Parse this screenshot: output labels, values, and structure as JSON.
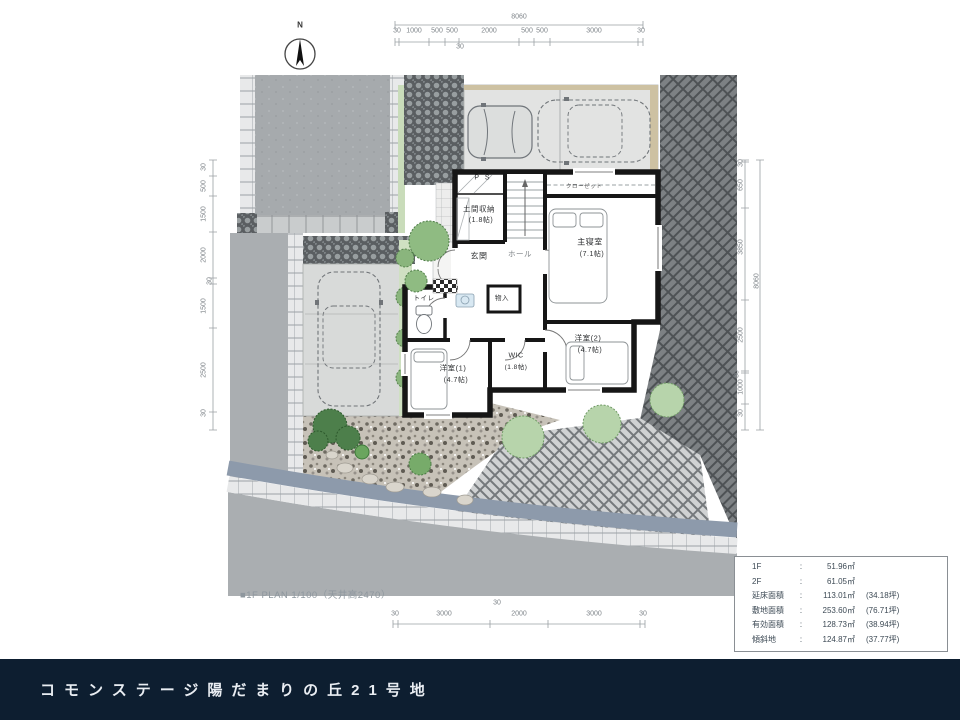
{
  "footer": {
    "title": "コモンステージ陽だまりの丘21号地"
  },
  "caption": "■1F PLAN 1/100（天井高2470）",
  "north_label": "N",
  "dimensions": {
    "top": {
      "total": "8060",
      "sub": "30",
      "segments": [
        "30",
        "1000",
        "500",
        "500",
        "2000",
        "500",
        "500",
        "3000",
        "30"
      ]
    },
    "bottom": {
      "sub": "30",
      "segments": [
        "30",
        "3000",
        "2000",
        "3000",
        "30"
      ]
    },
    "left": {
      "segments": [
        "30",
        "500",
        "1500",
        "2000",
        "30",
        "1500",
        "2500",
        "30"
      ]
    },
    "right": {
      "total": "8060",
      "segments": [
        "30",
        "650",
        "3850",
        "2500",
        "30",
        "1000",
        "30"
      ]
    }
  },
  "rooms": {
    "ps": "P S",
    "doma": "土間収納",
    "doma_size": "(1.8帖)",
    "genkan": "玄関",
    "hall": "ホール",
    "closet": "クローゼット",
    "master": "主寝室",
    "master_size": "(7.1帖)",
    "monoire": "物入",
    "toilet": "トイレ",
    "west1": "洋室(1)",
    "west1_size": "(4.7帖)",
    "wic": "WIC",
    "wic_size": "(1.8帖)",
    "west2": "洋室(2)",
    "west2_size": "(4.7帖)"
  },
  "area_table": {
    "colon": ":",
    "rows": [
      {
        "label": "1F",
        "value": "51.96㎡",
        "tsubo": ""
      },
      {
        "label": "2F",
        "value": "61.05㎡",
        "tsubo": ""
      },
      {
        "label": "延床面積",
        "value": "113.01㎡",
        "tsubo": "(34.18坪)"
      },
      {
        "label": "敷地面積",
        "value": "253.60㎡",
        "tsubo": "(76.71坪)"
      },
      {
        "label": "有効面積",
        "value": "128.73㎡",
        "tsubo": "(38.94坪)"
      },
      {
        "label": "傾斜地",
        "value": "124.87㎡",
        "tsubo": "(37.77坪)"
      }
    ]
  },
  "colors": {
    "footer_bg": "#0d1e30",
    "wall": "#161616",
    "road": "#a9adb1",
    "curb": "#8d9aab"
  }
}
